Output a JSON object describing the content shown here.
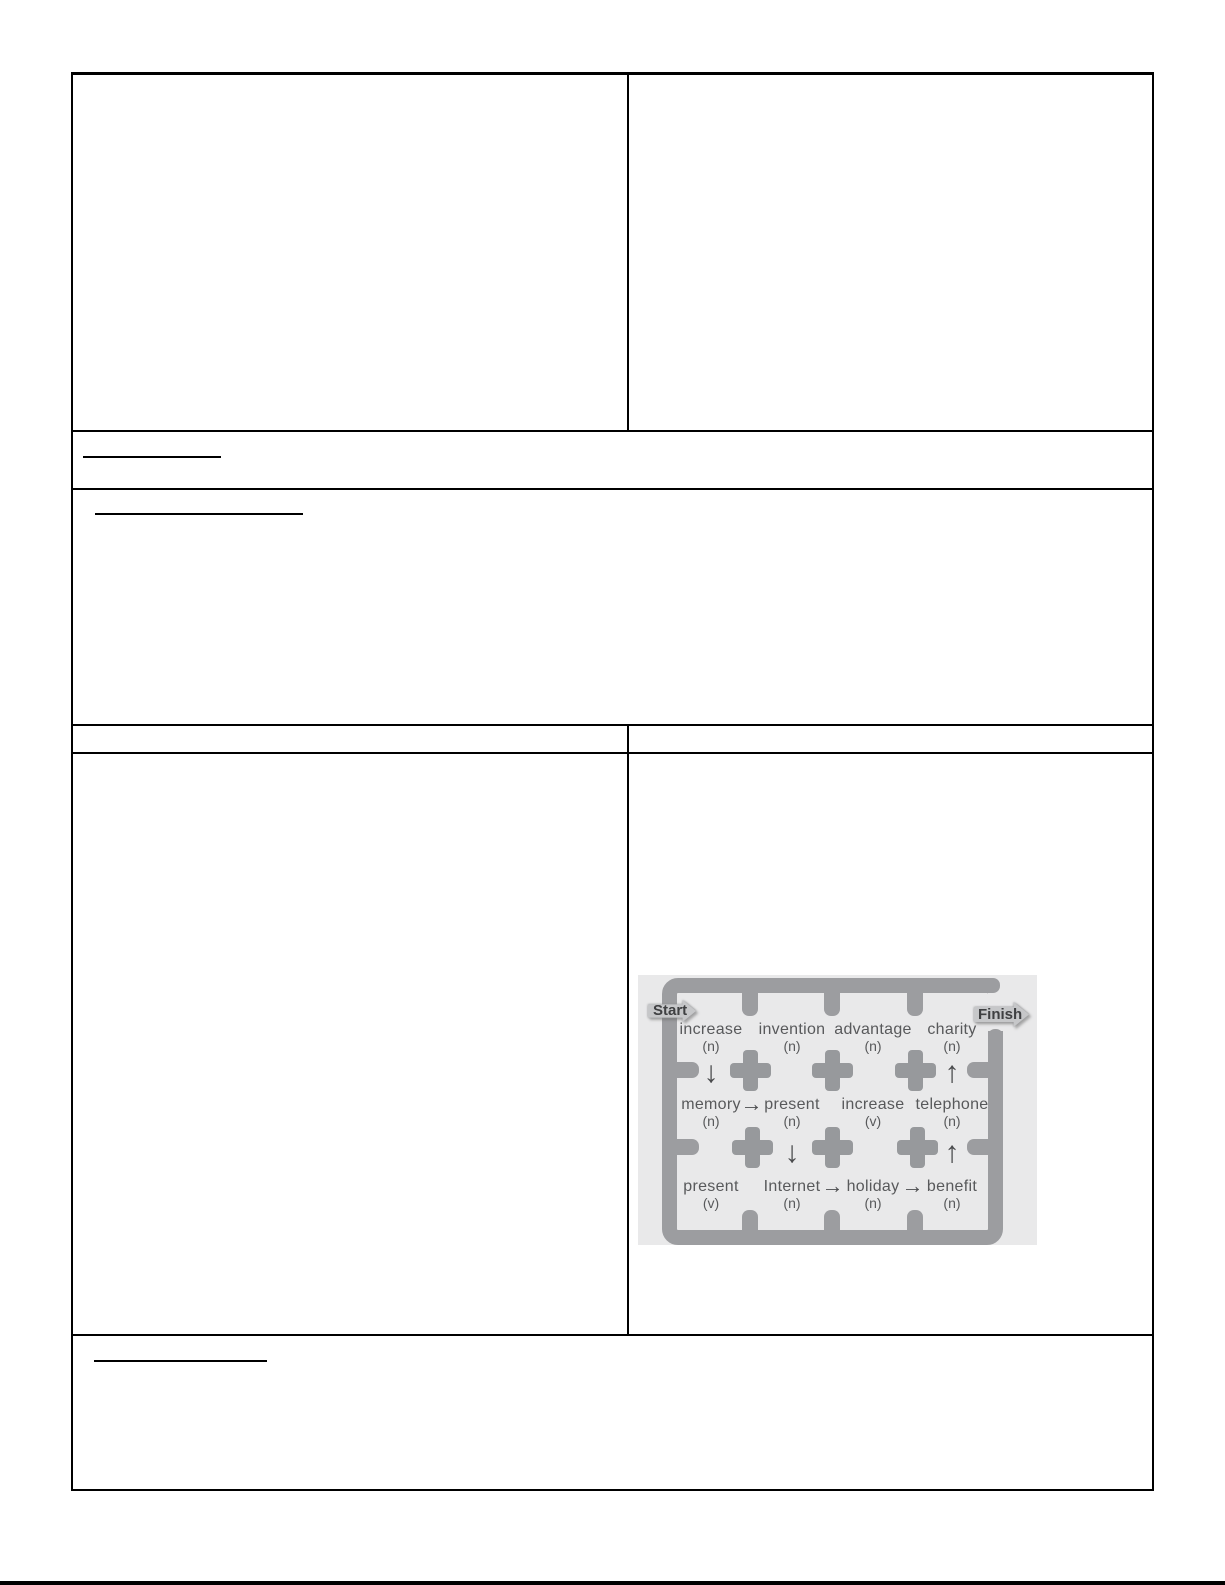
{
  "page": {
    "background": "#ffffff",
    "border_color": "#000000",
    "note": "blank worksheet table; all cells empty except embedded maze figure"
  },
  "maze": {
    "start_label": "Start",
    "finish_label": "Finish",
    "cells": [
      {
        "row": 0,
        "col": 0,
        "word": "increase",
        "pos": "(n)"
      },
      {
        "row": 0,
        "col": 1,
        "word": "invention",
        "pos": "(n)"
      },
      {
        "row": 0,
        "col": 2,
        "word": "advantage",
        "pos": "(n)"
      },
      {
        "row": 0,
        "col": 3,
        "word": "charity",
        "pos": "(n)"
      },
      {
        "row": 1,
        "col": 0,
        "word": "memory",
        "pos": "(n)"
      },
      {
        "row": 1,
        "col": 1,
        "word": "present",
        "pos": "(n)"
      },
      {
        "row": 1,
        "col": 2,
        "word": "increase",
        "pos": "(v)"
      },
      {
        "row": 1,
        "col": 3,
        "word": "telephone",
        "pos": "(n)"
      },
      {
        "row": 2,
        "col": 0,
        "word": "present",
        "pos": "(v)"
      },
      {
        "row": 2,
        "col": 1,
        "word": "Internet",
        "pos": "(n)"
      },
      {
        "row": 2,
        "col": 2,
        "word": "holiday",
        "pos": "(n)"
      },
      {
        "row": 2,
        "col": 3,
        "word": "benefit",
        "pos": "(n)"
      }
    ],
    "path_arrows": [
      {
        "glyph": "↓",
        "dir": "down",
        "from": "increase (n)",
        "to": "memory (n)",
        "col": 0,
        "gap": 0
      },
      {
        "glyph": "→",
        "dir": "right",
        "from": "memory (n)",
        "to": "present (n)",
        "row": 1,
        "aftercol": 0
      },
      {
        "glyph": "↓",
        "dir": "down",
        "from": "present (n)",
        "to": "Internet (n)",
        "col": 1,
        "gap": 1
      },
      {
        "glyph": "→",
        "dir": "right",
        "from": "Internet (n)",
        "to": "holiday (n)",
        "row": 2,
        "aftercol": 1
      },
      {
        "glyph": "→",
        "dir": "right",
        "from": "holiday (n)",
        "to": "benefit (n)",
        "row": 2,
        "aftercol": 2
      },
      {
        "glyph": "↑",
        "dir": "up",
        "from": "benefit (n)",
        "to": "telephone (n)",
        "col": 3,
        "gap": 1
      },
      {
        "glyph": "↑",
        "dir": "up",
        "from": "telephone (n)",
        "to": "charity (n)",
        "col": 3,
        "gap": 0
      }
    ],
    "colors": {
      "image_bg": "#e9e9ea",
      "wall": "#9c9da0",
      "cross": "#97999c",
      "text": "#58595b",
      "badge_fill": "#c6c7c9",
      "badge_text": "#3f4042"
    }
  }
}
